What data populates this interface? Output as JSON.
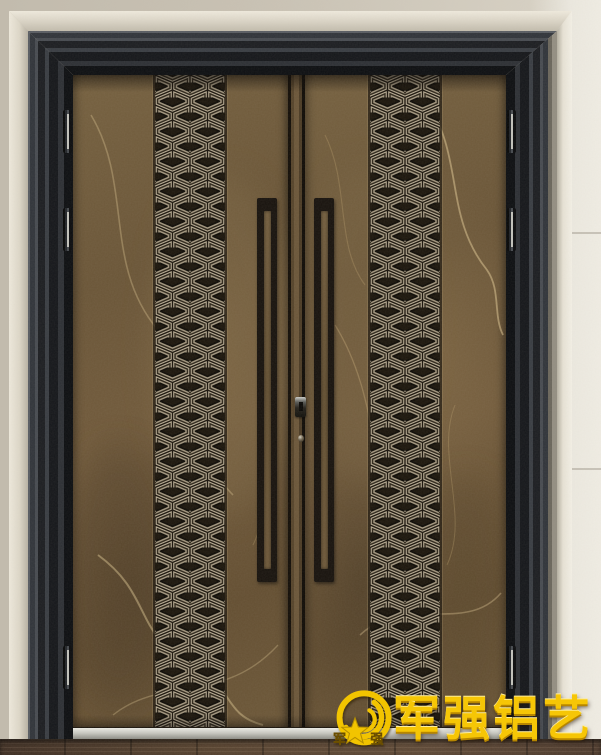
{
  "watermark": {
    "brand_text": "军强铝艺",
    "emblem_left_char": "军",
    "emblem_right_char": "强"
  },
  "palette": {
    "gold": "#f2c406",
    "door_marble_brown": "#6d583a",
    "pattern_relief_light": "#a89c85",
    "pattern_relief_dark": "#1b150c",
    "frame_metal_dark": "#24272b",
    "trim_cream": "#ded9cc",
    "wall_beige": "#c6bfb1",
    "threshold_silver": "#c9c9c2",
    "floor_brown": "#4c392c"
  }
}
